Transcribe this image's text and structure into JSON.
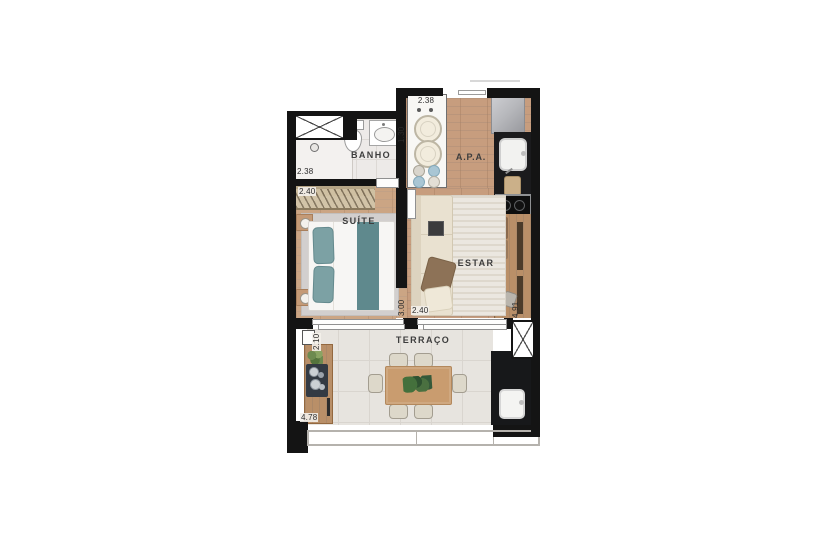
{
  "rooms": {
    "banho": "BANHO",
    "apa": "A.P.A.",
    "suite": "SUÍTE",
    "estar": "ESTAR",
    "terraco": "TERRAÇO"
  },
  "dims": {
    "banho_width": "2.38",
    "banho_depth": "1.30",
    "laundry_width": "2.38",
    "suite_width": "2.40",
    "suite_depth": "3.00",
    "estar_width": "2.40",
    "estar_depth": "4.91",
    "terraco_depth": "2.10",
    "terraco_width": "4.78"
  },
  "colors": {
    "wall": "#141414",
    "wood_floor": "#c79d7e",
    "tile_floor": "#e7e4df",
    "counter": "#1b1b1d",
    "bed_accent": "#7ca1a4",
    "sofa": "#e9e1d0",
    "table_wood": "#c99c6f",
    "plant": "#4a7040"
  }
}
